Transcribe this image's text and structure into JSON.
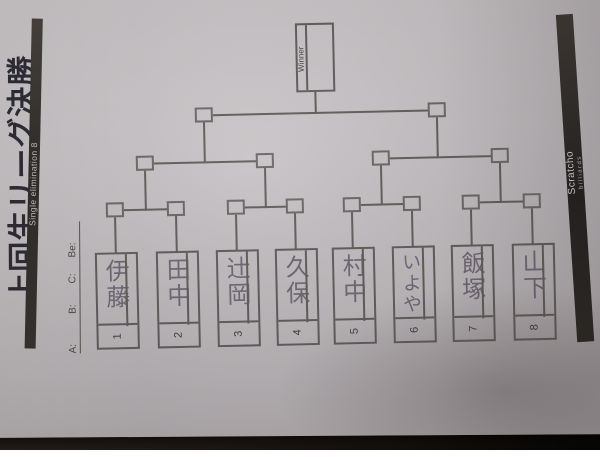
{
  "title_handwritten": "上回生リーグ決勝",
  "format_label": "Single elimination 8",
  "brand": {
    "name": "Scratcho",
    "sub": "billiards"
  },
  "winner_label": "Winner",
  "side_labels": {
    "a": "A:",
    "b": "B:",
    "c": "C:",
    "be": "Be:"
  },
  "participants": [
    {
      "seed": "1",
      "name": "伊藤"
    },
    {
      "seed": "2",
      "name": "田中"
    },
    {
      "seed": "3",
      "name": "辻岡"
    },
    {
      "seed": "4",
      "name": "久保"
    },
    {
      "seed": "5",
      "name": "村中"
    },
    {
      "seed": "6",
      "name": "いよや"
    },
    {
      "seed": "7",
      "name": "飯塚"
    },
    {
      "seed": "8",
      "name": "山下"
    }
  ],
  "colors": {
    "paper": "#c9c5c8",
    "table": "#17120e",
    "bar": "#35312d",
    "print_line": "#5f5c5a",
    "ink_title": "#2a2933",
    "ink_pen": "#6e6775"
  }
}
